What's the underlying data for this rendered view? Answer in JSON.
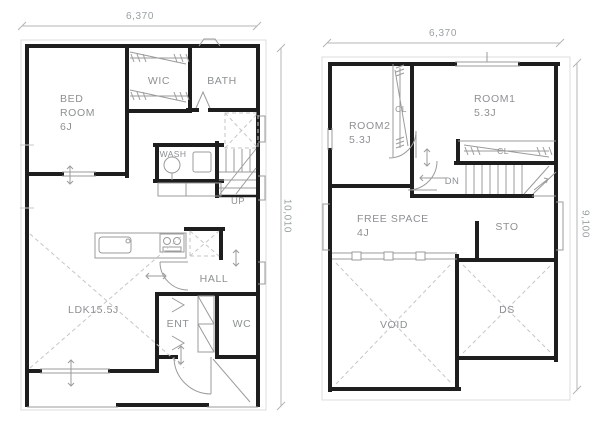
{
  "colors": {
    "wall": "#1e1e1e",
    "fixture_line": "#9b9b9b",
    "dashed_line": "#c6c6c6",
    "label_text": "#8d9092",
    "background": "#ffffff"
  },
  "first_floor": {
    "dim_width": "6,370",
    "dim_height": "10,010",
    "labels": {
      "bedroom": [
        "BED",
        "ROOM",
        "6J"
      ],
      "wic": "WIC",
      "bath": "BATH",
      "wash": "WASH",
      "up": "UP",
      "ldk": "LDK15.5J",
      "hall": "HALL",
      "entrance": "ENT",
      "wc": "WC"
    }
  },
  "second_floor": {
    "dim_width": "6,370",
    "dim_height": "9,100",
    "labels": {
      "room2": [
        "ROOM2",
        "5.3J"
      ],
      "room1": [
        "ROOM1",
        "5.3J"
      ],
      "closet_vertical": "CL",
      "closet_horizontal": "CL",
      "down": "DN",
      "free_space": [
        "FREE SPACE",
        "4J"
      ],
      "sto": "STO",
      "void": "VOID",
      "ds": "DS"
    }
  }
}
